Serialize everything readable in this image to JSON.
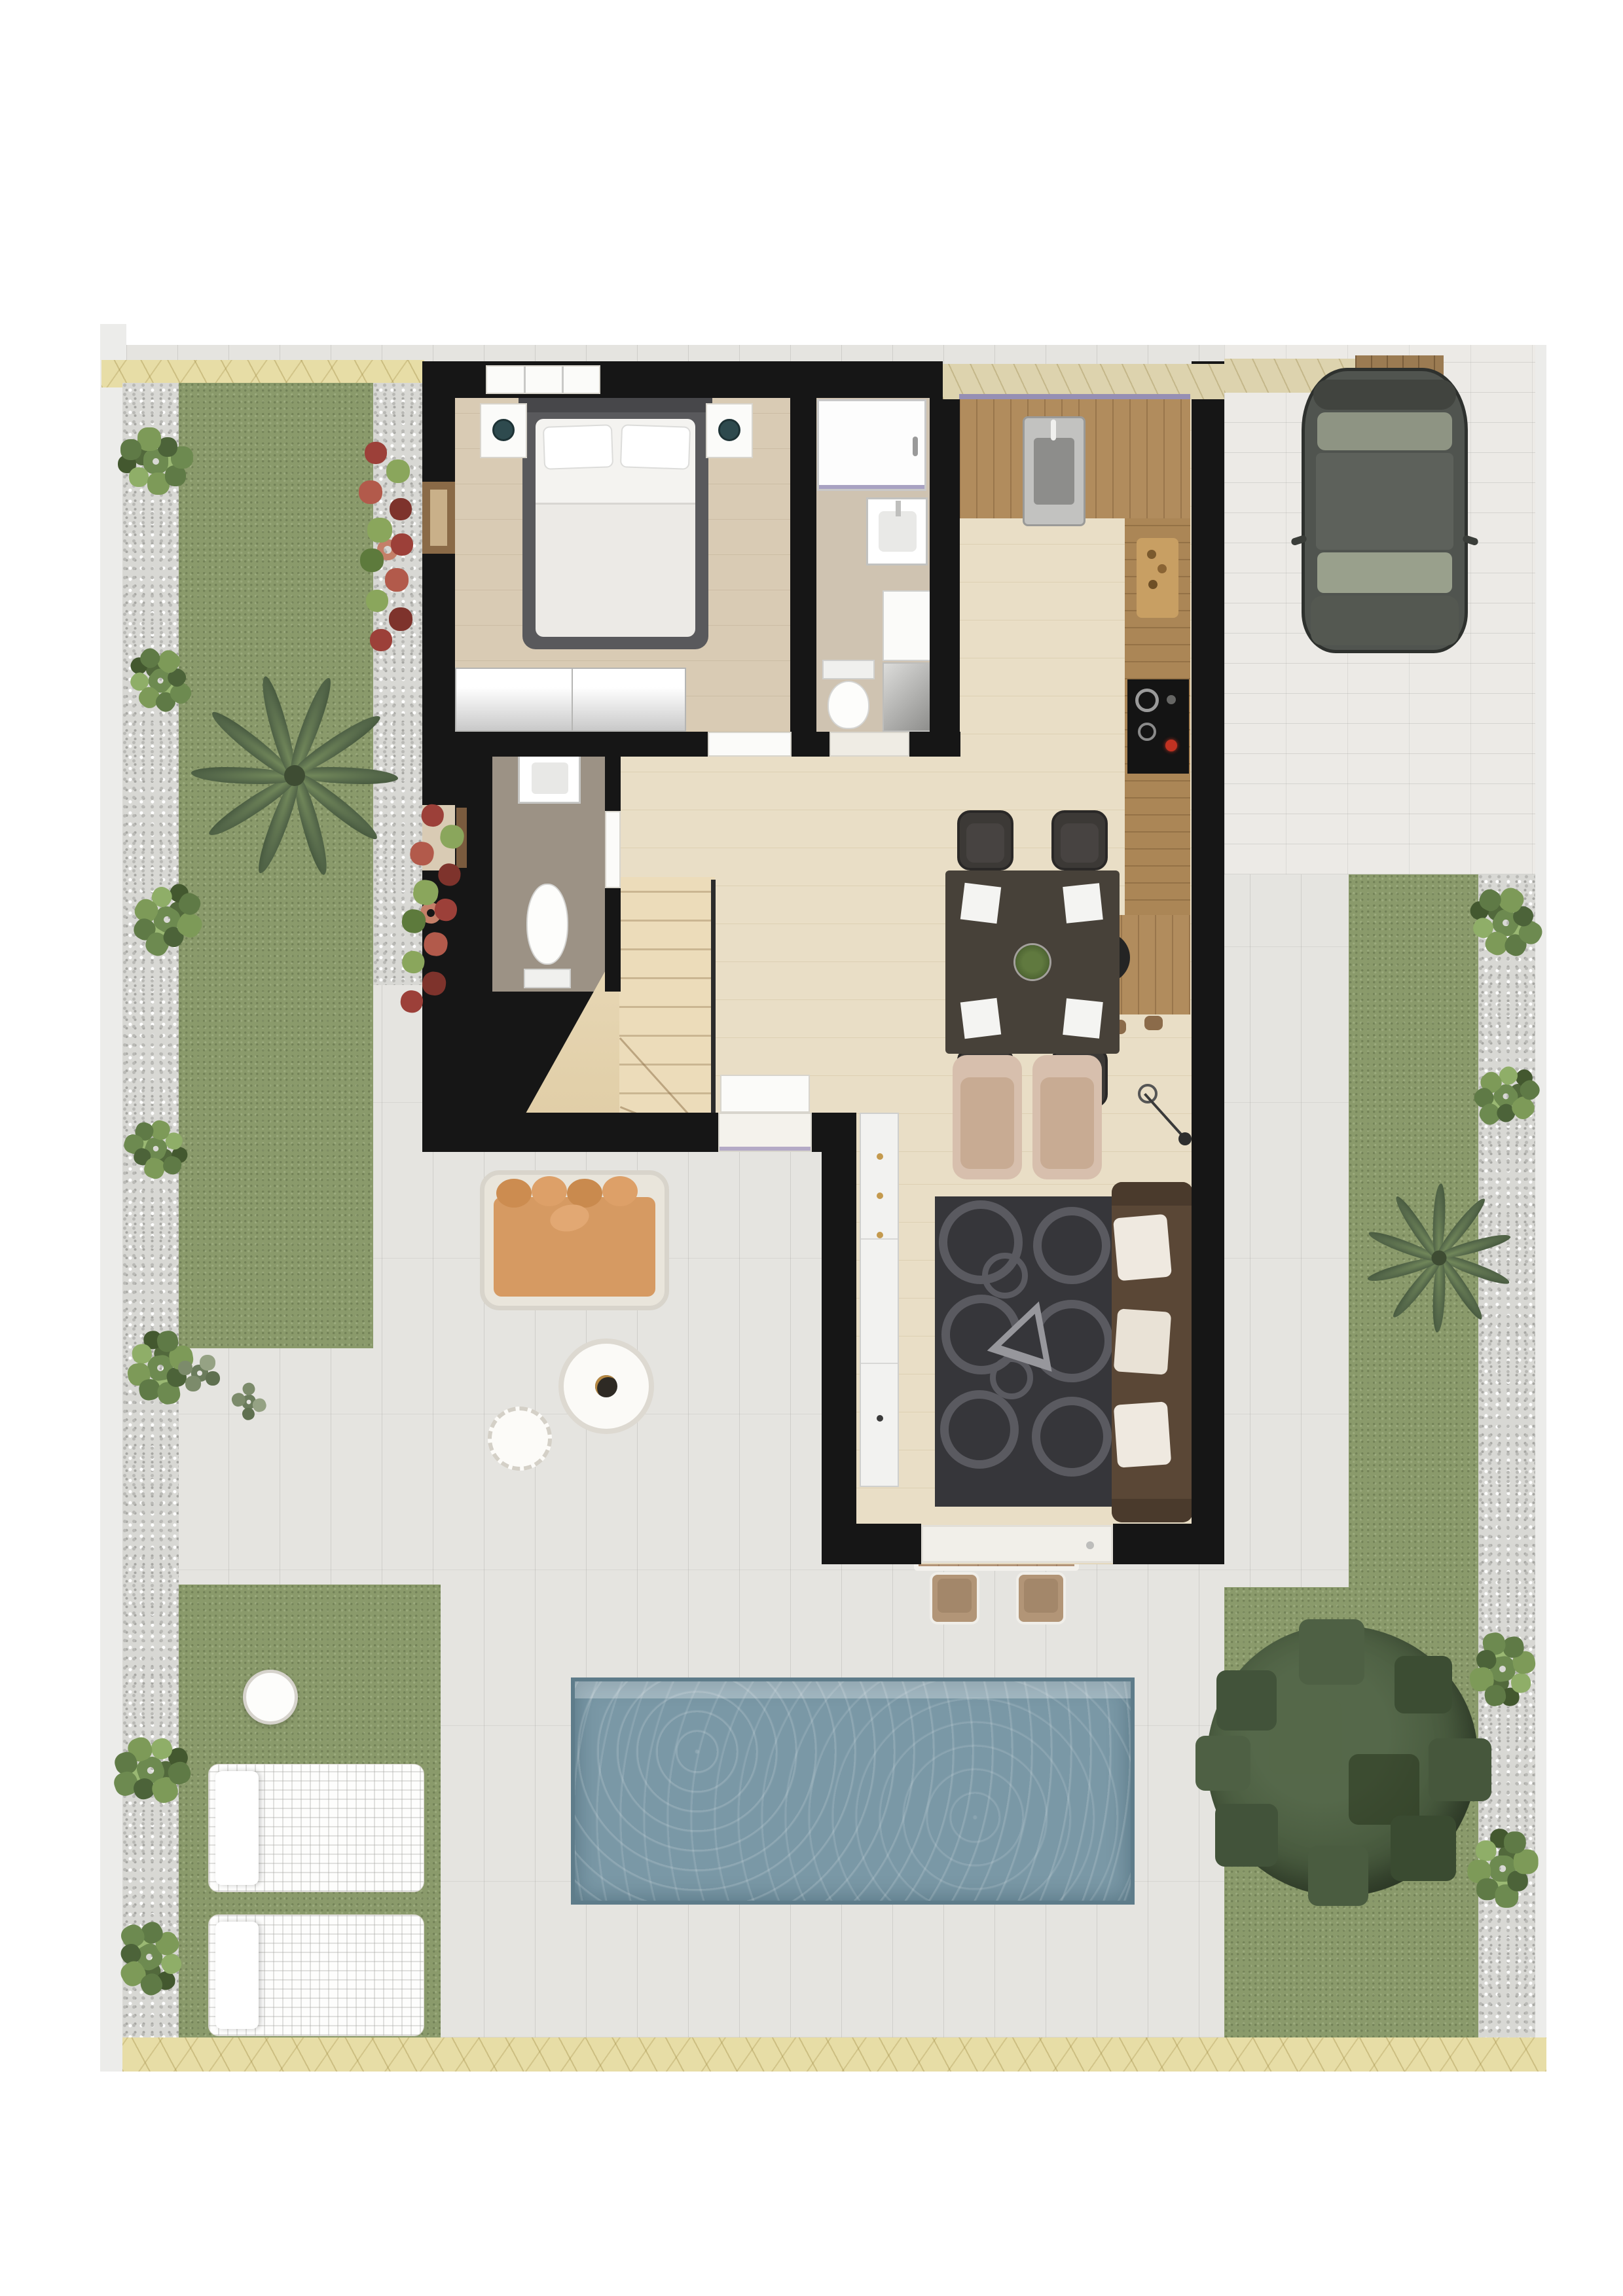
{
  "meta": {
    "type": "architectural floor plan",
    "view": "top-down photorealistic 3D render",
    "subject": "ground floor of a villa with garden, terrace, pool and driveway",
    "visible_text": "none"
  },
  "palette": {
    "wall": "#161616",
    "terrace_paving": "#e5e4e0",
    "driveway_paving": "#eceae6",
    "gravel": "#d8d8d4",
    "grass": "#8a9a6b",
    "stone_edge": "#e7dda6",
    "pool_water": "#7a98a6",
    "open_plan_floor": "#e9dec6",
    "bedroom_floor": "#d9cbb4",
    "bathroom_floor": "#cfc3b1",
    "wc_floor": "#9c9285",
    "kitchen_counter": "#b18c5d",
    "car_body": "#50544f",
    "accent_glass": "#9a92b8"
  },
  "house": {
    "label": "villa ground floor",
    "rooms": [
      {
        "name": "bedroom",
        "label": "Bedroom",
        "furniture": [
          "double bed with white bedding",
          "left nightstand with teal lamp",
          "right nightstand with teal lamp",
          "white wardrobe",
          "window above bed",
          "window on left wall"
        ]
      },
      {
        "name": "bathroom",
        "label": "Bathroom",
        "furniture": [
          "walk-in shower",
          "square washbasin",
          "toilet",
          "laundry cabinet with washing machine"
        ]
      },
      {
        "name": "guest-wc",
        "label": "Guest WC",
        "furniture": [
          "washbasin",
          "toilet"
        ]
      },
      {
        "name": "hallway",
        "label": "Hallway",
        "furniture": [
          "front door",
          "winder staircase with handrail"
        ]
      },
      {
        "name": "kitchen",
        "label": "Kitchen",
        "furniture": [
          "window counter with stone sill",
          "kitchen sink",
          "cutting board",
          "ceramic cooktop with red hot zone",
          "island with round wine rack",
          "3 bar stools"
        ]
      },
      {
        "name": "dining-area",
        "label": "Dining area",
        "furniture": [
          "dark dining table",
          "4 white placemats",
          "centerpiece plant",
          "4 dining chairs"
        ]
      },
      {
        "name": "living-area",
        "label": "Living area",
        "furniture": [
          "white TV sideboard",
          "2 beige armchairs",
          "dark patterned round-motif rug",
          "decorative triangle easel",
          "brown sofa with white cushions",
          "arc floor lamp",
          "terrace door",
          "glass garden door"
        ]
      }
    ]
  },
  "outdoor": {
    "terrace": {
      "label": "Terrace",
      "items": [
        "orange outdoor lounge sofa",
        "round white coffee table",
        "round white pouf"
      ]
    },
    "pool_area": {
      "label": "Pool area",
      "pool": "rectangular swimming pool",
      "items": [
        "outdoor dining table",
        "6 outdoor chairs"
      ]
    },
    "sunbathing_lawn": {
      "label": "Sunbathing lawn",
      "items": [
        "2 white sun loungers",
        "round white side table"
      ]
    },
    "driveway": {
      "label": "Driveway",
      "items": [
        "dark grey parked car"
      ]
    },
    "garden": {
      "label": "Garden",
      "items": [
        "palm tree left",
        "palm tree right",
        "large round tree",
        "11 green bushes",
        "2 red flower beds",
        "2 ornamental grass tufts",
        "lawn strips",
        "gravel borders",
        "stone edging top and bottom",
        "pale sidewalk strip"
      ]
    }
  }
}
